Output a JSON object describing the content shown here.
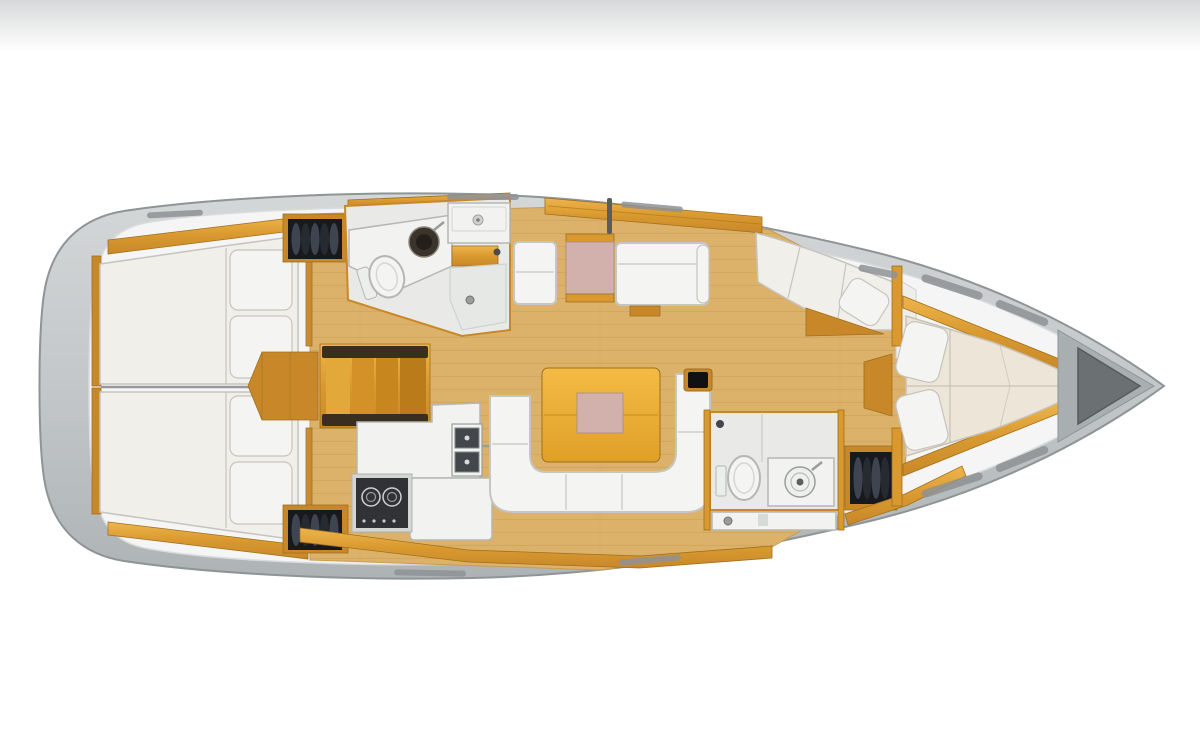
{
  "meta": {
    "type": "yacht-interior-floor-plan",
    "view": "top-down",
    "orientation": "bow-right-stern-left"
  },
  "colors": {
    "bg": "#ffffff",
    "fade-top": "#d7d8d9",
    "hull-hi": "#d4d7d8",
    "hull": "#c3c7c9",
    "hull-lo": "#aeb3b5",
    "hull-edge": "#8f9496",
    "deck": "#f4f5f4",
    "deck-shadow": "#d9dcdc",
    "anchor": "#6b7173",
    "anchor-deck": "#a9aeb0",
    "wood": "#d9992f",
    "wood-hi": "#eeb54d",
    "wood-mid": "#c8882a",
    "wood-dark": "#a06f1d",
    "floor": "#dcb26b",
    "floor-line": "#c89c52",
    "table-hi": "#f3bb45",
    "table-lo": "#e0a028",
    "pink": "#d2b1ad",
    "pink-edge": "#b18f8b",
    "mattress": "#f1efe9",
    "mattress-edge": "#c6c4be",
    "vberth": "#ece5d8",
    "vberth-edge": "#c8c2b4",
    "sofa": "#f4f4f2",
    "sofa-edge": "#c5c5c1",
    "fixture": "#f2f3f1",
    "fixture-edge": "#b4b7b5",
    "room": "#e9eae8",
    "room-edge": "#cfd2d0",
    "shower": "#e6e8e6",
    "dark": "#303236",
    "basin": "#43464a",
    "locker": "#17191d",
    "locker-hi": "#3e4450",
    "metal": "#9a9d9b",
    "slot": "#8e9294",
    "screen": "#101113",
    "rail-dark": "#3a2f1f"
  },
  "areas": [
    {
      "name": "aft-cabin-upper",
      "fixtures": [
        "double-berth",
        "two-pillows",
        "wood-shelf",
        "hanging-locker-with-clothes"
      ]
    },
    {
      "name": "aft-cabin-lower",
      "fixtures": [
        "double-berth",
        "two-pillows",
        "wood-shelf",
        "hanging-locker-with-clothes"
      ]
    },
    {
      "name": "companionway",
      "fixtures": [
        "wood-stairs",
        "side-landing"
      ]
    },
    {
      "name": "head-forward-upper",
      "fixtures": [
        "toilet",
        "round-dark-washbasin",
        "corner-counter",
        "sink-unit-with-faucet",
        "wood-cabinet",
        "shower-drain"
      ]
    },
    {
      "name": "galley-lower",
      "fixtures": [
        "two-burner-stove",
        "double-square-sink-with-faucet",
        "l-shaped-counter"
      ]
    },
    {
      "name": "saloon",
      "fixtures": [
        "u-shaped-white-sofa",
        "yellow-dining-table-with-pink-center",
        "small-screen",
        "two-facing-benches",
        "pink-chart-table",
        "mast-post"
      ]
    },
    {
      "name": "lounge-corner-starboard-bow",
      "fixtures": [
        "corner-cushions",
        "loose-pillow",
        "wood-floor-wedge"
      ]
    },
    {
      "name": "head-aft-lower",
      "fixtures": [
        "toilet",
        "round-washbasin-unit",
        "shower-strip-with-drain",
        "hanging-locker-with-clothes"
      ]
    },
    {
      "name": "owner-cabin-bow",
      "fixtures": [
        "v-berth",
        "two-pillows",
        "wood-side-shelves",
        "deck-hatch-slots",
        "bulkhead-with-door"
      ]
    },
    {
      "name": "bow-tip",
      "fixtures": [
        "anchor-locker"
      ]
    }
  ]
}
